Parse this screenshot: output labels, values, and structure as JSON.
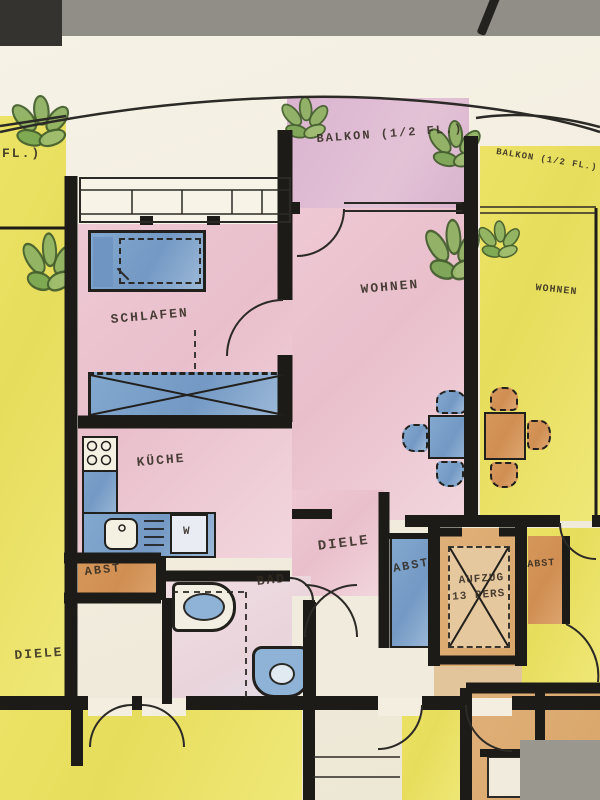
{
  "document": {
    "type": "hand-colored architectural floor plan (photo of paper)",
    "language": "de"
  },
  "palette": {
    "paper": "#f3eee0",
    "photo_gray": "#918e88",
    "yellow": "#e8de5f",
    "pink": "#ebc5d0",
    "lavender": "#d9b3cf",
    "blue_furniture": "#7ea4cc",
    "orange": "#d49257",
    "plant_green": "#8fb262",
    "wall_ink": "#1d1b18",
    "label_ink": "#332c22"
  },
  "rooms": {
    "balkon_left_partial": "FL.)",
    "balkon_center": "BALKON (1/2 FL.)",
    "balkon_right": "BALKON (1/2 FL.)",
    "schlafen": "SCHLAFEN",
    "wohnen": "WOHNEN",
    "wohnen_neighbor": "WOHNEN",
    "kueche": "KÜCHE",
    "diele": "DIELE",
    "diele_lower": "DIELE",
    "bad": "BAD",
    "abst_left": "ABST",
    "abst_center": "ABST",
    "abst_right": "ABST",
    "aufzug_line1": "AUFZUG",
    "aufzug_line2": "13 PERS.",
    "washer": "W"
  }
}
